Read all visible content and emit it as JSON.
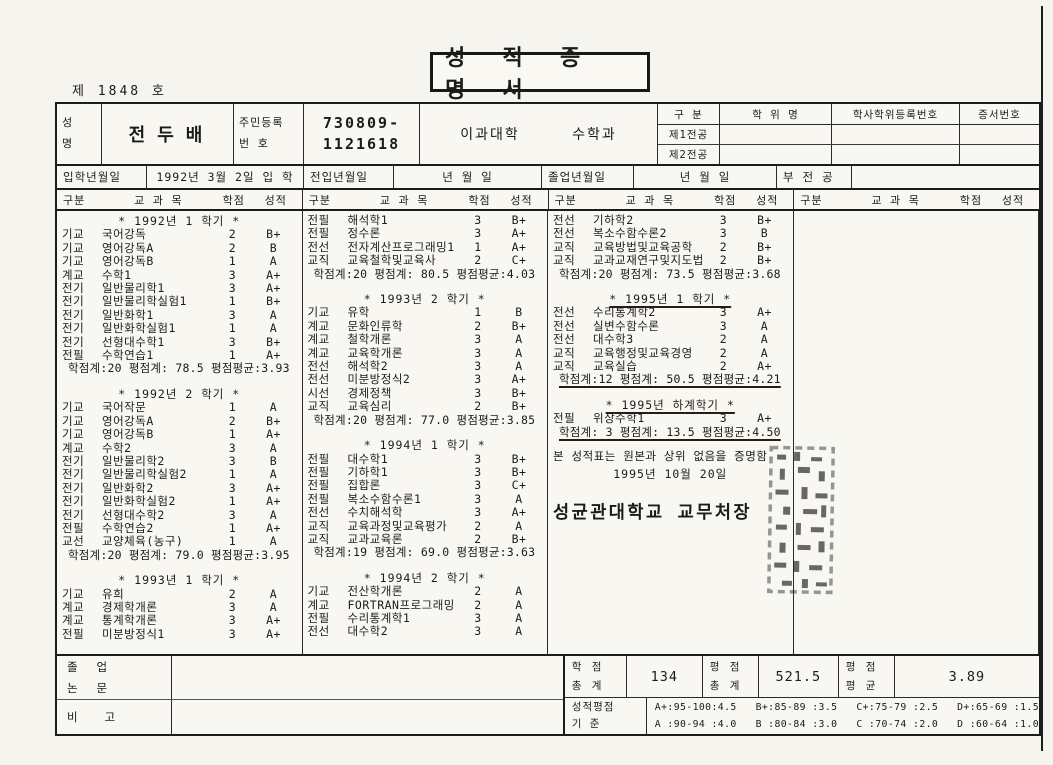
{
  "page": {
    "doc_number": "제  1848 호",
    "title": "성 적 증 명 서"
  },
  "student": {
    "name_label": "성\n명",
    "name": "전두배",
    "id_label": "주민등록\n번    호",
    "id_line1": "730809-",
    "id_line2": "1121618",
    "college": "이과대학",
    "department": "수학과"
  },
  "degree": {
    "col_gubun": "구  분",
    "col_degree_name": "학  위  명",
    "col_reg_no": "학사학위등록번호",
    "col_cert_no": "증서번호",
    "rows": [
      {
        "label": "제1전공",
        "degree_name": "",
        "reg_no": "",
        "cert_no": ""
      },
      {
        "label": "제2전공",
        "degree_name": "",
        "reg_no": "",
        "cert_no": ""
      }
    ]
  },
  "dates": {
    "admission_label": "입학년월일",
    "admission_value": "1992년  3월  2일  입 학",
    "transfer_label": "전입년월일",
    "transfer_value": "년      월      일",
    "graduation_label": "졸업년월일",
    "graduation_value": "년      월      일",
    "minor_label": "부 전 공",
    "minor_value": ""
  },
  "course_header": {
    "gubun": "구분",
    "subject": "교   과   목",
    "credit": "학점",
    "grade": "성적"
  },
  "transcript_columns": [
    {
      "blocks": [
        {
          "kind": "title",
          "text": "*  1992년 1 학기  *"
        },
        {
          "kind": "course",
          "gubun": "기교",
          "name": "국어강독",
          "credit": "2",
          "grade": "B+"
        },
        {
          "kind": "course",
          "gubun": "기교",
          "name": "영어강독A",
          "credit": "2",
          "grade": "B"
        },
        {
          "kind": "course",
          "gubun": "기교",
          "name": "영어강독B",
          "credit": "1",
          "grade": "A"
        },
        {
          "kind": "course",
          "gubun": "계교",
          "name": "수학1",
          "credit": "3",
          "grade": "A+"
        },
        {
          "kind": "course",
          "gubun": "전기",
          "name": "일반물리학1",
          "credit": "3",
          "grade": "A+"
        },
        {
          "kind": "course",
          "gubun": "전기",
          "name": "일반물리학실험1",
          "credit": "1",
          "grade": "B+"
        },
        {
          "kind": "course",
          "gubun": "전기",
          "name": "일반화학1",
          "credit": "3",
          "grade": "A"
        },
        {
          "kind": "course",
          "gubun": "전기",
          "name": "일반화학실험1",
          "credit": "1",
          "grade": "A"
        },
        {
          "kind": "course",
          "gubun": "전기",
          "name": "선형대수학1",
          "credit": "3",
          "grade": "B+"
        },
        {
          "kind": "course",
          "gubun": "전필",
          "name": "수학연습1",
          "credit": "1",
          "grade": "A+"
        },
        {
          "kind": "summary",
          "text": "학점계:20  평점계: 78.5  평점평균:3.93"
        },
        {
          "kind": "title",
          "text": "*  1992년 2 학기  *"
        },
        {
          "kind": "course",
          "gubun": "기교",
          "name": "국어작문",
          "credit": "1",
          "grade": "A"
        },
        {
          "kind": "course",
          "gubun": "기교",
          "name": "영어강독A",
          "credit": "2",
          "grade": "B+"
        },
        {
          "kind": "course",
          "gubun": "기교",
          "name": "영어강독B",
          "credit": "1",
          "grade": "A+"
        },
        {
          "kind": "course",
          "gubun": "계교",
          "name": "수학2",
          "credit": "3",
          "grade": "A"
        },
        {
          "kind": "course",
          "gubun": "전기",
          "name": "일반물리학2",
          "credit": "3",
          "grade": "B"
        },
        {
          "kind": "course",
          "gubun": "전기",
          "name": "일반물리학실험2",
          "credit": "1",
          "grade": "A"
        },
        {
          "kind": "course",
          "gubun": "전기",
          "name": "일반화학2",
          "credit": "3",
          "grade": "A+"
        },
        {
          "kind": "course",
          "gubun": "전기",
          "name": "일반화학실험2",
          "credit": "1",
          "grade": "A+"
        },
        {
          "kind": "course",
          "gubun": "전기",
          "name": "선형대수학2",
          "credit": "3",
          "grade": "A"
        },
        {
          "kind": "course",
          "gubun": "전필",
          "name": "수학연습2",
          "credit": "1",
          "grade": "A+"
        },
        {
          "kind": "course",
          "gubun": "교선",
          "name": "교양체육(농구)",
          "credit": "1",
          "grade": "A"
        },
        {
          "kind": "summary",
          "text": "학점계:20  평점계: 79.0  평점평균:3.95"
        },
        {
          "kind": "title",
          "text": "*  1993년 1 학기  *"
        },
        {
          "kind": "course",
          "gubun": "기교",
          "name": "유희",
          "credit": "2",
          "grade": "A"
        },
        {
          "kind": "course",
          "gubun": "계교",
          "name": "경제학개론",
          "credit": "3",
          "grade": "A"
        },
        {
          "kind": "course",
          "gubun": "계교",
          "name": "통계학개론",
          "credit": "3",
          "grade": "A+"
        },
        {
          "kind": "course",
          "gubun": "전필",
          "name": "미분방정식1",
          "credit": "3",
          "grade": "A+"
        }
      ]
    },
    {
      "blocks": [
        {
          "kind": "course",
          "gubun": "전필",
          "name": "해석학1",
          "credit": "3",
          "grade": "B+"
        },
        {
          "kind": "course",
          "gubun": "전필",
          "name": "정수론",
          "credit": "3",
          "grade": "A+"
        },
        {
          "kind": "course",
          "gubun": "전선",
          "name": "전자계산프로그래밍1",
          "credit": "1",
          "grade": "A+"
        },
        {
          "kind": "course",
          "gubun": "교직",
          "name": "교육철학및교육사",
          "credit": "2",
          "grade": "C+"
        },
        {
          "kind": "summary",
          "text": "학점계:20  평점계: 80.5  평점평균:4.03"
        },
        {
          "kind": "title",
          "text": "*  1993년 2 학기  *"
        },
        {
          "kind": "course",
          "gubun": "기교",
          "name": "유학",
          "credit": "1",
          "grade": "B"
        },
        {
          "kind": "course",
          "gubun": "계교",
          "name": "문화인류학",
          "credit": "2",
          "grade": "B+"
        },
        {
          "kind": "course",
          "gubun": "계교",
          "name": "철학개론",
          "credit": "3",
          "grade": "A"
        },
        {
          "kind": "course",
          "gubun": "계교",
          "name": "교육학개론",
          "credit": "3",
          "grade": "A"
        },
        {
          "kind": "course",
          "gubun": "전선",
          "name": "해석학2",
          "credit": "3",
          "grade": "A"
        },
        {
          "kind": "course",
          "gubun": "전선",
          "name": "미분방정식2",
          "credit": "3",
          "grade": "A+"
        },
        {
          "kind": "course",
          "gubun": "시선",
          "name": "경제정책",
          "credit": "3",
          "grade": "B+"
        },
        {
          "kind": "course",
          "gubun": "교직",
          "name": "교육심리",
          "credit": "2",
          "grade": "B+"
        },
        {
          "kind": "summary",
          "text": "학점계:20  평점계: 77.0  평점평균:3.85"
        },
        {
          "kind": "title",
          "text": "*  1994년 1 학기  *"
        },
        {
          "kind": "course",
          "gubun": "전필",
          "name": "대수학1",
          "credit": "3",
          "grade": "B+"
        },
        {
          "kind": "course",
          "gubun": "전필",
          "name": "기하학1",
          "credit": "3",
          "grade": "B+"
        },
        {
          "kind": "course",
          "gubun": "전필",
          "name": "집합론",
          "credit": "3",
          "grade": "C+"
        },
        {
          "kind": "course",
          "gubun": "전필",
          "name": "복소수함수론1",
          "credit": "3",
          "grade": "A"
        },
        {
          "kind": "course",
          "gubun": "전선",
          "name": "수치해석학",
          "credit": "3",
          "grade": "A+"
        },
        {
          "kind": "course",
          "gubun": "교직",
          "name": "교육과정및교육평가",
          "credit": "2",
          "grade": "A"
        },
        {
          "kind": "course",
          "gubun": "교직",
          "name": "교과교육론",
          "credit": "2",
          "grade": "B+"
        },
        {
          "kind": "summary",
          "text": "학점계:19  평점계: 69.0  평점평균:3.63"
        },
        {
          "kind": "title",
          "text": "*  1994년 2 학기  *"
        },
        {
          "kind": "course",
          "gubun": "기교",
          "name": "전산학개론",
          "credit": "2",
          "grade": "A"
        },
        {
          "kind": "course",
          "gubun": "계교",
          "name": "FORTRAN프로그래밍",
          "credit": "2",
          "grade": "A"
        },
        {
          "kind": "course",
          "gubun": "전필",
          "name": "수리통계학1",
          "credit": "3",
          "grade": "A"
        },
        {
          "kind": "course",
          "gubun": "전선",
          "name": "대수학2",
          "credit": "3",
          "grade": "A"
        }
      ]
    },
    {
      "blocks": [
        {
          "kind": "course",
          "gubun": "전선",
          "name": "기하학2",
          "credit": "3",
          "grade": "B+"
        },
        {
          "kind": "course",
          "gubun": "전선",
          "name": "복소수함수론2",
          "credit": "3",
          "grade": "B"
        },
        {
          "kind": "course",
          "gubun": "교직",
          "name": "교육방법및교육공학",
          "credit": "2",
          "grade": "B+"
        },
        {
          "kind": "course",
          "gubun": "교직",
          "name": "교과교재연구및지도법",
          "credit": "2",
          "grade": "B+"
        },
        {
          "kind": "summary",
          "text": "학점계:20  평점계: 73.5  평점평균:3.68"
        },
        {
          "kind": "title",
          "text": "*  1995년 1 학기  *",
          "underline": true
        },
        {
          "kind": "course",
          "gubun": "전선",
          "name": "수리통계학2",
          "credit": "3",
          "grade": "A+"
        },
        {
          "kind": "course",
          "gubun": "전선",
          "name": "실변수함수론",
          "credit": "3",
          "grade": "A"
        },
        {
          "kind": "course",
          "gubun": "전선",
          "name": "대수학3",
          "credit": "2",
          "grade": "A"
        },
        {
          "kind": "course",
          "gubun": "교직",
          "name": "교육행정및교육경영",
          "credit": "2",
          "grade": "A"
        },
        {
          "kind": "course",
          "gubun": "교직",
          "name": "교육실습",
          "credit": "2",
          "grade": "A+"
        },
        {
          "kind": "summary",
          "text": "학점계:12  평점계: 50.5  평점평균:4.21",
          "underline": true
        },
        {
          "kind": "title",
          "text": "*  1995년 하계학기  *",
          "underline": true
        },
        {
          "kind": "course",
          "gubun": "전필",
          "name": "위상수학1",
          "credit": "3",
          "grade": "A+"
        },
        {
          "kind": "summary",
          "text": "학점계: 3  평점계: 13.5  평점평균:4.50",
          "underline": true
        }
      ]
    },
    {
      "blocks": []
    }
  ],
  "certificate": {
    "statement": "본 성적표는 원본과 상위 없음을 증명함",
    "date": "1995년 10월 20일",
    "issuer": "성균관대학교 교무처장"
  },
  "totals": {
    "credits_label": "학    점\n총    계",
    "credits": "134",
    "points_label": "평    점\n총    계",
    "points": "521.5",
    "gpa_label": "평    점\n평    균",
    "gpa": "3.89"
  },
  "grade_scale": {
    "label": "성적평점\n기    준",
    "line1": "A+:95-100:4.5   B+:85-89 :3.5   C+:75-79 :2.5   D+:65-69 :1.5",
    "line2": "A :90-94 :4.0   B :80-84 :3.0   C :70-74 :2.0   D :60-64 :1.0"
  },
  "footer": {
    "thesis_label": "졸 업\n논 문",
    "remarks_label": "비    고"
  }
}
